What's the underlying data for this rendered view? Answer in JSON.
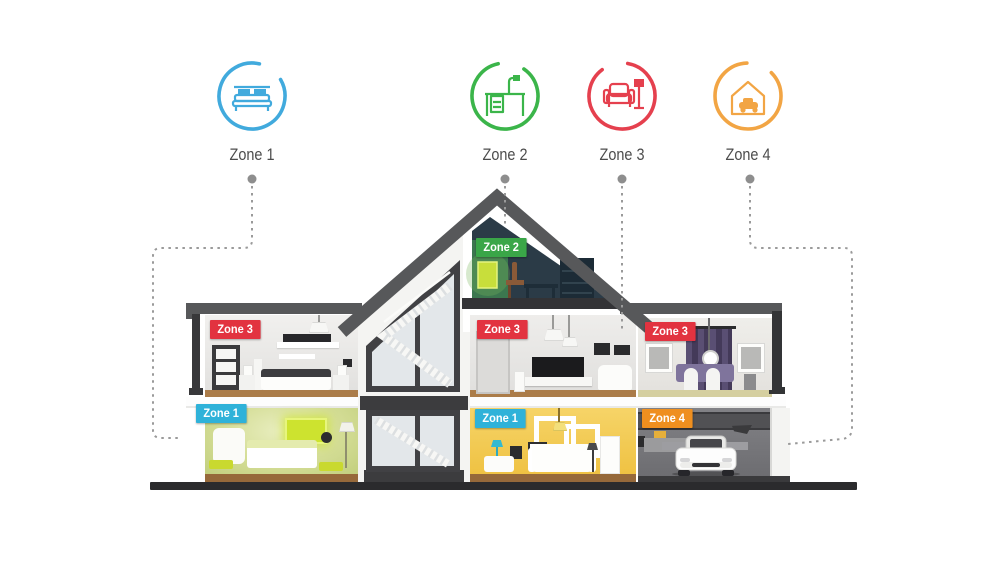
{
  "legend": {
    "zones": [
      {
        "label": "Zone 1",
        "color": "#41aadd",
        "icon": "bed-icon"
      },
      {
        "label": "Zone 2",
        "color": "#3bb54a",
        "icon": "desk-lamp-icon"
      },
      {
        "label": "Zone 3",
        "color": "#e5404e",
        "icon": "sofa-floor-lamp-icon"
      },
      {
        "label": "Zone 4",
        "color": "#f2a544",
        "icon": "garage-car-icon"
      }
    ]
  },
  "house": {
    "badges": {
      "attic_study": {
        "label": "Zone 2",
        "color": "#3aa648"
      },
      "bedroom_upper_left": {
        "label": "Zone 3",
        "color": "#e23340"
      },
      "living_room_upper_center": {
        "label": "Zone 3",
        "color": "#e23340"
      },
      "dining_room_upper_right": {
        "label": "Zone 3",
        "color": "#e23340"
      },
      "bedroom_ground_left": {
        "label": "Zone 1",
        "color": "#2fb2d9"
      },
      "living_room_ground_center": {
        "label": "Zone 1",
        "color": "#2fb2d9"
      },
      "garage": {
        "label": "Zone 4",
        "color": "#ef8f1f"
      }
    },
    "connector_color": "#9a9a9a",
    "roof_color": "#57585a"
  }
}
